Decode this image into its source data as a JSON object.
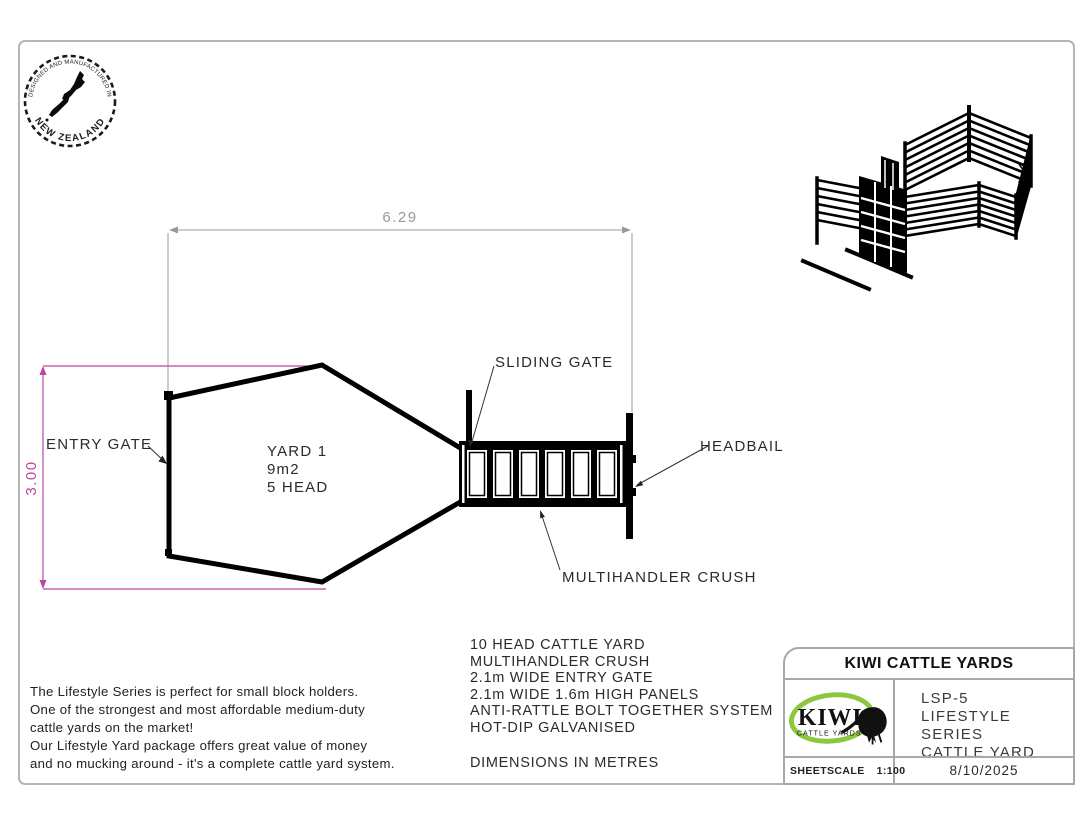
{
  "stamp": {
    "top_text": "DESIGNED AND MANUFACTURED IN",
    "bottom_text": "NEW ZEALAND"
  },
  "plan": {
    "dim_width": "6.29",
    "dim_height": "3.00",
    "yard": {
      "name": "YARD 1",
      "area": "9m2",
      "capacity": "5 HEAD"
    },
    "labels": {
      "entry_gate": "ENTRY GATE",
      "sliding_gate": "SLIDING GATE",
      "headbail": "HEADBAIL",
      "crush": "MULTIHANDLER CRUSH"
    }
  },
  "description": {
    "lines": [
      "The Lifestyle Series is perfect for small block holders.",
      "One of the strongest and most affordable medium-duty",
      "cattle yards on the market!",
      "Our Lifestyle Yard package offers great value of money",
      "and no mucking around - it's a complete cattle yard system."
    ]
  },
  "specs": {
    "lines": [
      "10 HEAD CATTLE YARD",
      "MULTIHANDLER CRUSH",
      "2.1m WIDE ENTRY GATE",
      "2.1m WIDE 1.6m HIGH PANELS",
      "ANTI-RATTLE BOLT TOGETHER SYSTEM",
      "HOT-DIP GALVANISED"
    ],
    "note": "DIMENSIONS IN METRES"
  },
  "title_block": {
    "title": "KIWI CATTLE YARDS",
    "model": "LSP-5",
    "series": "LIFESTYLE SERIES",
    "product": "CATTLE YARD",
    "sheet_label": "SHEETSCALE",
    "scale": "1:100",
    "date": "8/10/2025"
  },
  "logo": {
    "brand": "KIWI",
    "sub": "CATTLE YARDS"
  },
  "colors": {
    "dimension_gray": "#9a9a9a",
    "dimension_magenta": "#bf44a1",
    "logo_green": "#8dc63f",
    "line_black": "#000000",
    "border_gray": "#b5b5b5"
  }
}
